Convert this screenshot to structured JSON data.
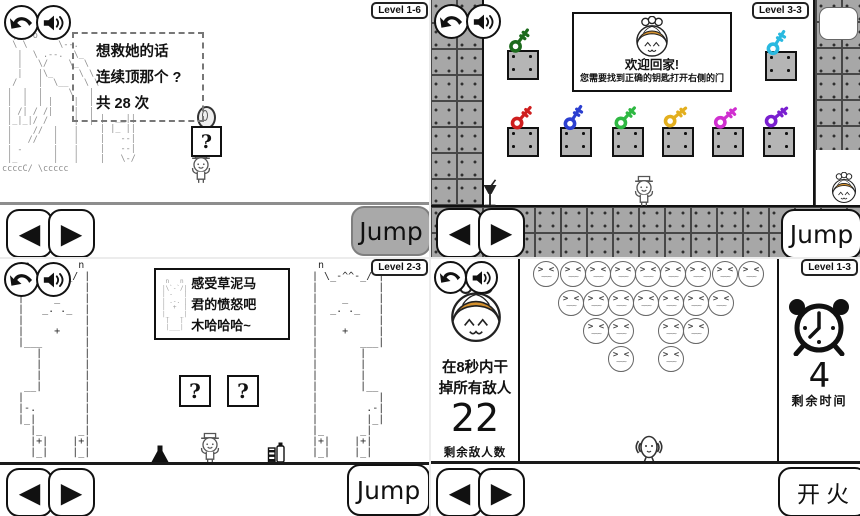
{
  "shared": {
    "question_mark": "?",
    "icons": {
      "left_arrow": "◀",
      "right_arrow": "▶"
    }
  },
  "colors": {
    "princess_hair": "#d4912f",
    "tile_gray": "#a7a7a7",
    "block_gray": "#b5b5b5",
    "jump_pressed_gray": "#a9a9a9"
  },
  "quadrants": {
    "q1": {
      "level_label": "Level 1-6",
      "dialog_lines": [
        "想救她的话",
        "连续顶那个 ?",
        "共 28 次"
      ],
      "jump_label": "Jump",
      "ascii_giant": "  /|  |-|\n  |_| o o\\_\n  \\ \\      \\--.\n   |  \\ .--.  \\_\n   |   \\/    \\_ \\\n   |   |\\_     \\ \\\n  /    |  \\__   \\ \\\n |  |  |     \\   |\n |  |  | |    |  |\n | /| / /|    |  |\n |_|_|/ /     |  |\n |    //  |   |\n |   //   |   |\n | -      |   |\n |_       |   |\nccccC/ \\ccccc",
      "ascii_stairs": "|  __||\n| |_ ||\n|   --|\n|   --|\n|   \\-/"
    },
    "q2": {
      "level_label": "Level 3-3",
      "dialog_title": "欢迎回家!",
      "dialog_subtitle": "您需要找到正确的钥匙打开右侧的门",
      "jump_label": "Jump",
      "keys": [
        {
          "name": "dark-green",
          "color": "#1c6b1c",
          "x": 77,
          "y": 27,
          "tilt": -10
        },
        {
          "name": "cyan",
          "color": "#29b9e0",
          "x": 334,
          "y": 29,
          "tilt": -14
        },
        {
          "name": "red",
          "color": "#cf1f1f",
          "x": 79,
          "y": 104,
          "tilt": -6
        },
        {
          "name": "blue",
          "color": "#2b3fd0",
          "x": 131,
          "y": 104,
          "tilt": -14
        },
        {
          "name": "green",
          "color": "#2eb842",
          "x": 183,
          "y": 104,
          "tilt": -4
        },
        {
          "name": "gold",
          "color": "#e3af1e",
          "x": 233,
          "y": 103,
          "tilt": 4
        },
        {
          "name": "magenta",
          "color": "#d02fd0",
          "x": 283,
          "y": 104,
          "tilt": 2
        },
        {
          "name": "purple",
          "color": "#7a1fd0",
          "x": 334,
          "y": 103,
          "tilt": 4
        }
      ],
      "blocks": [
        {
          "x": 77,
          "y": 50
        },
        {
          "x": 335,
          "y": 51
        },
        {
          "x": 77,
          "y": 127
        },
        {
          "x": 130,
          "y": 127
        },
        {
          "x": 182,
          "y": 127
        },
        {
          "x": 232,
          "y": 127
        },
        {
          "x": 282,
          "y": 127
        },
        {
          "x": 333,
          "y": 127
        }
      ]
    },
    "q3": {
      "level_label": "Level 2-3",
      "dialog_lines": [
        "感受草泥马",
        "君的愤怒吧",
        "木哈哈哈~"
      ],
      "jump_label": "Jump",
      "ascii_llama_left": "   n        n\n  | \\_-^^-_/ |\n  |          |\n  |     _    |\n  |   _. ._  |\n  |          |\n  |     +    |\n  |___       |\n     |       |\n     |       |\n     |       |\n   __|       |\n  |          |\n  |-.        |\n  |_|        |\n    |_      _|\n    |+|    |+|\n    |_|    |_|",
      "ascii_llama_right": "  n        n\n | \\_-^^-_/ |\n |          |\n |    _     |\n |  _. ._   |\n |          |\n |    +     |\n |       ___|\n |       |\n |       |\n |       |\n |       |__\n |          |\n |        .-|\n |        |_|\n |_      _|\n |+|    |+|\n |_|    |_|",
      "ascii_llama_mini": " n   n\n|\\`-`/|\n| -   |\n| .-. |\n|  +  |\n|_   _|\n |   |\n |___|"
    },
    "q4": {
      "level_label": "Level 1-3",
      "instruction_lines": [
        "在8秒内干",
        "掉所有敌人"
      ],
      "enemies_remaining": "22",
      "enemies_remaining_label": "剩余敌人数",
      "time_remaining": "4",
      "time_remaining_label": "剩余时间",
      "fire_label": "开火",
      "enemy_face": {
        "eyes": "> <",
        "mouth": "~~~"
      },
      "enemy_rows": [
        {
          "y": 3,
          "xs": [
            103,
            130,
            155,
            180,
            205,
            230,
            255,
            282,
            308
          ]
        },
        {
          "y": 32,
          "xs": [
            128,
            153,
            178,
            203,
            228,
            253,
            278
          ]
        },
        {
          "y": 60,
          "xs": [
            153,
            178,
            228,
            253
          ]
        },
        {
          "y": 88,
          "xs": [
            178,
            228
          ]
        }
      ]
    }
  }
}
